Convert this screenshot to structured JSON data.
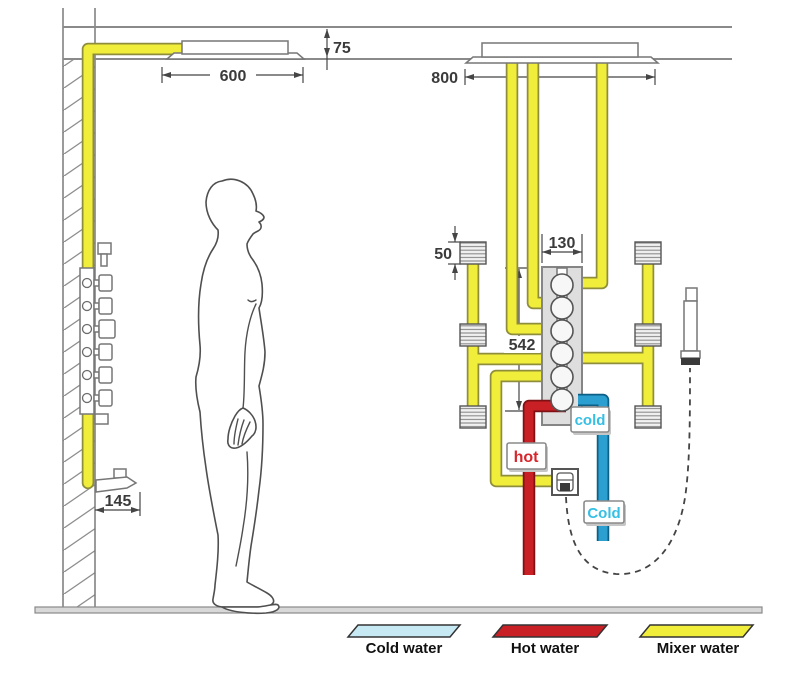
{
  "dimensions": {
    "recess_depth": "75",
    "left_head_width": "600",
    "right_head_width": "800",
    "valve_body_width": "130",
    "valve_drop": "542",
    "jet_size": "50",
    "spout_reach": "145"
  },
  "labels": {
    "hot": "hot",
    "cold": "cold",
    "cold_supply": "Cold"
  },
  "legend": {
    "items": [
      {
        "label": "Cold water",
        "color": "#c6e9f4"
      },
      {
        "label": "Hot water",
        "color": "#c92026"
      },
      {
        "label": "Mixer water",
        "color": "#f1ee3b"
      }
    ]
  },
  "colors": {
    "mixer_pipe": "#f1ee3b",
    "hot_pipe": "#c92026",
    "cold_pipe": "#2b9fd0",
    "hot_text": "#d6262c",
    "cold_text": "#35bfe4"
  }
}
